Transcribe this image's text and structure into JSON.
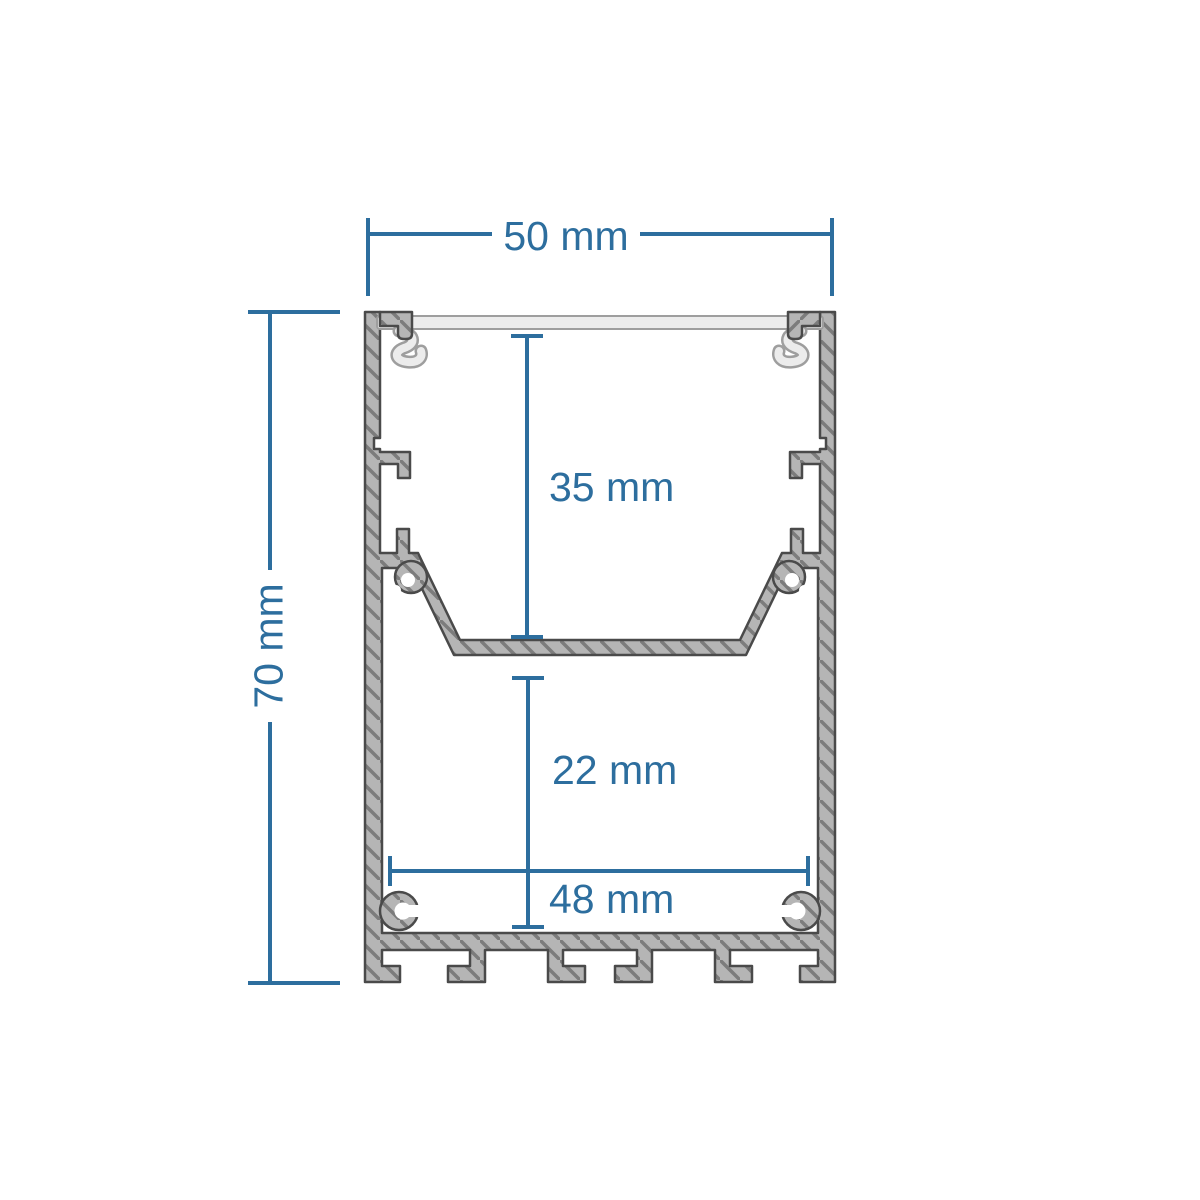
{
  "page": {
    "background": "#ffffff"
  },
  "diagram": {
    "name": "led-profile-cross-section",
    "description": "Aluminium LED strip profile extrusion cross-section with dimension callouts",
    "dimensions": {
      "overall_width": {
        "label": "50 mm",
        "value": 50,
        "unit": "mm",
        "orientation": "horizontal",
        "measures": "outer width of profile"
      },
      "overall_height": {
        "label": "70 mm",
        "value": 70,
        "unit": "mm",
        "orientation": "vertical",
        "measures": "outer height of profile"
      },
      "upper_cavity_depth": {
        "label": "35 mm",
        "value": 35,
        "unit": "mm",
        "orientation": "vertical",
        "measures": "depth from diffuser to LED tray"
      },
      "lower_cavity_height": {
        "label": "22 mm",
        "value": 22,
        "unit": "mm",
        "orientation": "vertical",
        "measures": "height of lower wiring compartment"
      },
      "inner_width": {
        "label": "48 mm",
        "value": 48,
        "unit": "mm",
        "orientation": "horizontal",
        "measures": "inner width of lower compartment"
      }
    },
    "colors": {
      "dimension_blue": "#2D6E9E",
      "profile_fill": "#B5B5B5",
      "hatch_line": "#7C7C7C",
      "profile_outline": "#4A4A4A",
      "diffuser_fill": "#ECECEC",
      "diffuser_outline": "#9E9E9E",
      "background": "#FFFFFF"
    }
  }
}
